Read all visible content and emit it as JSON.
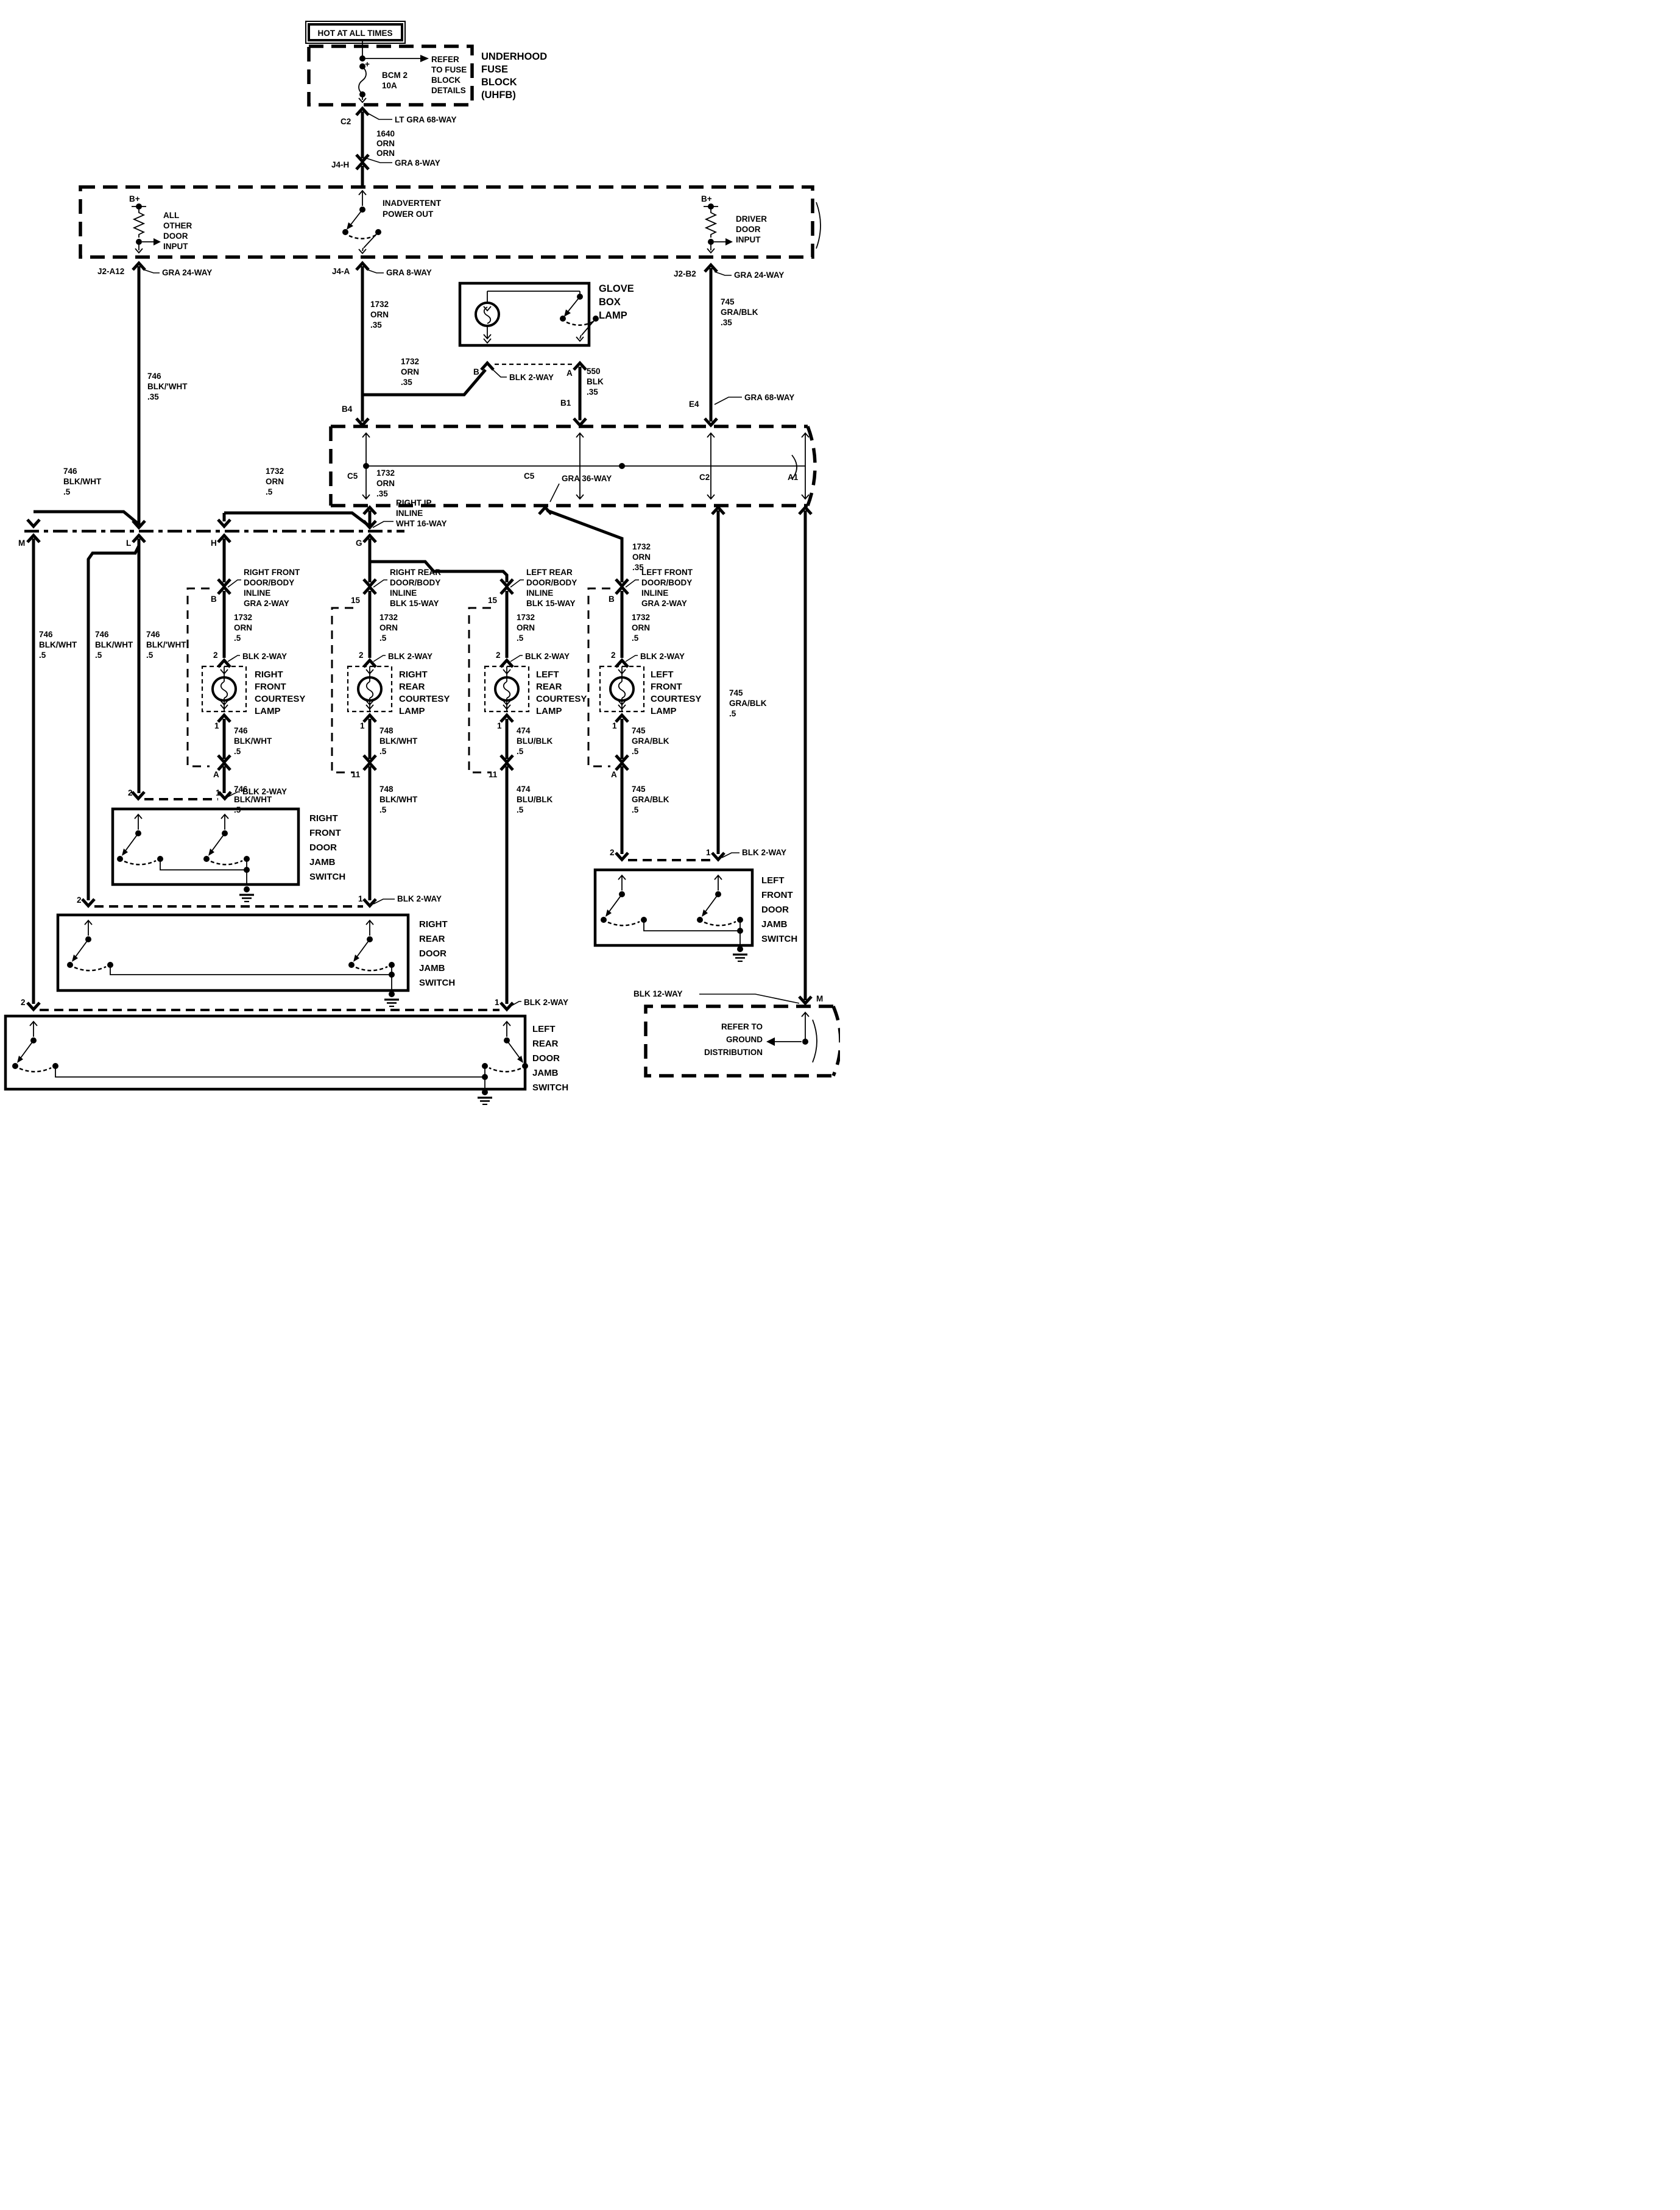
{
  "title": "Interior courtesy lamp wiring diagram",
  "colors": {
    "ink": "#000000",
    "paper": "#ffffff"
  },
  "power": {
    "hot": "HOT AT ALL TIMES",
    "fuse_block": {
      "name": [
        "UNDERHOOD",
        "FUSE",
        "BLOCK",
        "(UHFB)"
      ],
      "note": [
        "REFER",
        "TO FUSE",
        "BLOCK",
        "DETAILS"
      ],
      "fuse": [
        "BCM 2",
        "10A"
      ],
      "plus": "+"
    },
    "c2_pin": "C2",
    "c2_conn": "LT GRA 68-WAY",
    "wire_1640": [
      "1640",
      "ORN",
      "ORN"
    ],
    "j4h_pin": "J4-H",
    "j4h_conn": "GRA 8-WAY"
  },
  "bcm": {
    "b_plus_left": "B+",
    "all_other": [
      "ALL",
      "OTHER",
      "DOOR",
      "INPUT"
    ],
    "inadvertent": [
      "INADVERTENT",
      "POWER OUT"
    ],
    "b_plus_right": "B+",
    "driver": [
      "DRIVER",
      "DOOR",
      "INPUT"
    ],
    "j2a12": {
      "pin": "J2-A12",
      "conn": "GRA 24-WAY",
      "wire": [
        "746",
        "BLK/'WHT",
        ".35"
      ]
    },
    "j4a": {
      "pin": "J4-A",
      "conn": "GRA 8-WAY",
      "wire": [
        "1732",
        "ORN",
        ".35"
      ]
    },
    "j2b2": {
      "pin": "J2-B2",
      "conn": "GRA 24-WAY",
      "wire": [
        "745",
        "GRA/BLK",
        ".35"
      ]
    }
  },
  "glove_box": {
    "name": [
      "GLOVE",
      "BOX",
      "LAMP"
    ],
    "pin_b": "B",
    "pin_a": "A",
    "conn": "BLK 2-WAY",
    "wire_branch": [
      "1732",
      "ORN",
      ".35"
    ],
    "wire_550": [
      "550",
      "BLK",
      ".35"
    ],
    "pin_b1": "B1",
    "pin_b4": "B4"
  },
  "body_harness": {
    "pin_e4": "E4",
    "conn_e4": "GRA 68-WAY",
    "pin_c5_left": "C5",
    "wire_c5_left": [
      "1732",
      "ORN",
      ".35"
    ],
    "pin_c5_right": "C5",
    "conn_c5_right": "GRA 36-WAY",
    "wire_c5_right": [
      "1732",
      "ORN",
      ".35"
    ],
    "pin_c2": "C2",
    "wire_c2": [
      "745",
      "GRA/BLK",
      ".5"
    ],
    "pin_a1": "A1"
  },
  "ip_inline": {
    "name": [
      "RIGHT IP",
      "INLINE",
      "WHT 16-WAY"
    ],
    "pin_m": "M",
    "pin_l": "L",
    "pin_h": "H",
    "pin_g": "G",
    "branch_746": [
      "746",
      "BLK/WHT",
      ".5"
    ],
    "branch_1732": [
      "1732",
      "ORN",
      ".5"
    ],
    "feed_m": [
      "746",
      "BLK/WHT",
      ".5"
    ],
    "feed_rr": [
      "746",
      "BLK/WHT",
      ".5"
    ],
    "feed_rf": [
      "746",
      "BLK/'WHT",
      ".5"
    ]
  },
  "lamps": {
    "rf": {
      "inline": [
        "RIGHT FRONT",
        "DOOR/BODY",
        "INLINE",
        "GRA 2-WAY"
      ],
      "pin_top": "B",
      "wire_feed": [
        "1732",
        "ORN",
        ".5"
      ],
      "pin2": "2",
      "conn2": "BLK 2-WAY",
      "name": [
        "RIGHT",
        "FRONT",
        "COURTESY",
        "LAMP"
      ],
      "pin1": "1",
      "wire_ret1": [
        "746",
        "BLK/WHT",
        ".5"
      ],
      "pin_bot": "A",
      "wire_ret2": [
        "746",
        "BLK/WHT",
        ".5"
      ]
    },
    "rr": {
      "inline": [
        "RIGHT REAR",
        "DOOR/BODY",
        "INLINE",
        "BLK 15-WAY"
      ],
      "pin_top": "15",
      "wire_feed": [
        "1732",
        "ORN",
        ".5"
      ],
      "pin2": "2",
      "conn2": "BLK 2-WAY",
      "name": [
        "RIGHT",
        "REAR",
        "COURTESY",
        "LAMP"
      ],
      "pin1": "1",
      "wire_ret1": [
        "748",
        "BLK/WHT",
        ".5"
      ],
      "pin_bot": "11",
      "wire_ret2": [
        "748",
        "BLK/WHT",
        ".5"
      ]
    },
    "lr": {
      "inline": [
        "LEFT REAR",
        "DOOR/BODY",
        "INLINE",
        "BLK 15-WAY"
      ],
      "pin_top": "15",
      "wire_feed": [
        "1732",
        "ORN",
        ".5"
      ],
      "pin2": "2",
      "conn2": "BLK 2-WAY",
      "name": [
        "LEFT",
        "REAR",
        "COURTESY",
        "LAMP"
      ],
      "pin1": "1",
      "wire_ret1": [
        "474",
        "BLU/BLK",
        ".5"
      ],
      "pin_bot": "11",
      "wire_ret2": [
        "474",
        "BLU/BLK",
        ".5"
      ]
    },
    "lf": {
      "inline": [
        "LEFT FRONT",
        "DOOR/BODY",
        "INLINE",
        "GRA 2-WAY"
      ],
      "pin_top": "B",
      "wire_feed": [
        "1732",
        "ORN",
        ".5"
      ],
      "pin2": "2",
      "conn2": "BLK 2-WAY",
      "name": [
        "LEFT",
        "FRONT",
        "COURTESY",
        "LAMP"
      ],
      "pin1": "1",
      "wire_ret1": [
        "745",
        "GRA/BLK",
        ".5"
      ],
      "pin_bot": "A",
      "wire_ret2": [
        "745",
        "GRA/BLK",
        ".5"
      ]
    }
  },
  "switches": {
    "rf": {
      "name": [
        "RIGHT",
        "FRONT",
        "DOOR",
        "JAMB",
        "SWITCH"
      ],
      "pin2": "2",
      "pin1": "1",
      "conn": "BLK 2-WAY"
    },
    "rr": {
      "name": [
        "RIGHT",
        "REAR",
        "DOOR",
        "JAMB",
        "SWITCH"
      ],
      "pin2": "2",
      "pin1": "1",
      "conn": "BLK 2-WAY"
    },
    "lr": {
      "name": [
        "LEFT",
        "REAR",
        "DOOR",
        "JAMB",
        "SWITCH"
      ],
      "pin2": "2",
      "pin1": "1",
      "conn": "BLK 2-WAY"
    },
    "lf": {
      "name": [
        "LEFT",
        "FRONT",
        "DOOR",
        "JAMB",
        "SWITCH"
      ],
      "pin2": "2",
      "pin1": "1",
      "conn": "BLK 2-WAY"
    }
  },
  "ground": {
    "conn": "BLK 12-WAY",
    "pin": "M",
    "note": [
      "REFER TO",
      "GROUND",
      "DISTRIBUTION"
    ]
  }
}
